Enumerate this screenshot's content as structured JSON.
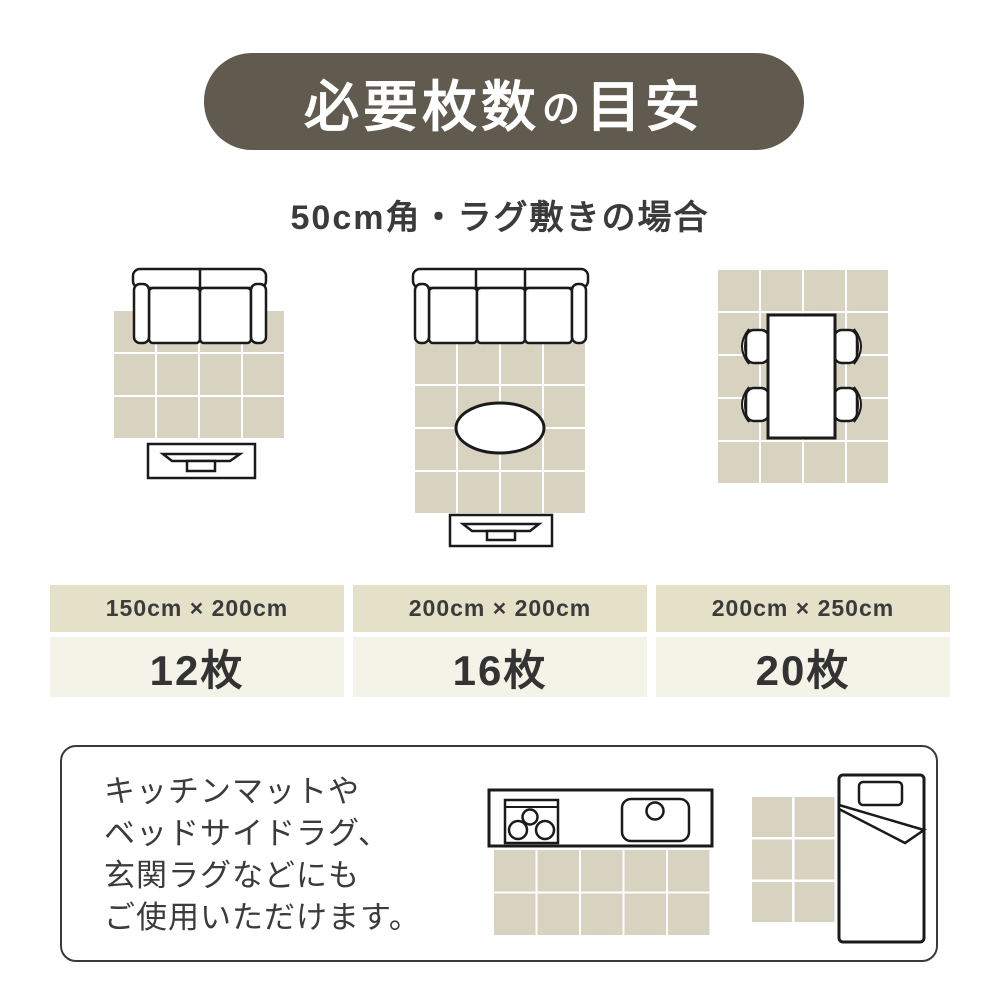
{
  "header": {
    "title_part1": "必要枚数",
    "title_particle": "の",
    "title_part2": "目安",
    "subtitle": "50cm角・ラグ敷きの場合"
  },
  "colors": {
    "banner_bg": "#615a4e",
    "tile": "#d8d2c0",
    "table_header_bg": "#e5e0c8",
    "table_value_bg": "#f4f3e8",
    "text_dark": "#3b3b3b",
    "line": "#1a1a1a"
  },
  "size_table": {
    "columns": [
      {
        "size": "150cm × 200cm",
        "count": "12枚"
      },
      {
        "size": "200cm × 200cm",
        "count": "16枚"
      },
      {
        "size": "200cm × 250cm",
        "count": "20枚"
      }
    ]
  },
  "diagrams": [
    {
      "name": "two-seat-sofa-with-tv-board",
      "rug_size": "150cm × 200cm",
      "tiles": 12
    },
    {
      "name": "three-seat-sofa-with-oval-table-and-tv-board",
      "rug_size": "200cm × 200cm",
      "tiles": 16
    },
    {
      "name": "dining-table-with-four-chairs",
      "rug_size": "200cm × 250cm",
      "tiles": 20
    }
  ],
  "grids": [
    {
      "id": "rug-grid-1",
      "cols": 4,
      "rows": 3
    },
    {
      "id": "rug-grid-2",
      "cols": 4,
      "rows": 4
    },
    {
      "id": "rug-grid-3",
      "cols": 4,
      "rows": 5
    },
    {
      "id": "kitchen-mat-grid",
      "cols": 5,
      "rows": 2
    },
    {
      "id": "bedside-rug-grid",
      "cols": 2,
      "rows": 3
    }
  ],
  "note": {
    "lines": [
      "キッチンマットや",
      "ベッドサイドラグ、",
      "玄関ラグなどにも",
      "ご使用いただけます。"
    ]
  }
}
